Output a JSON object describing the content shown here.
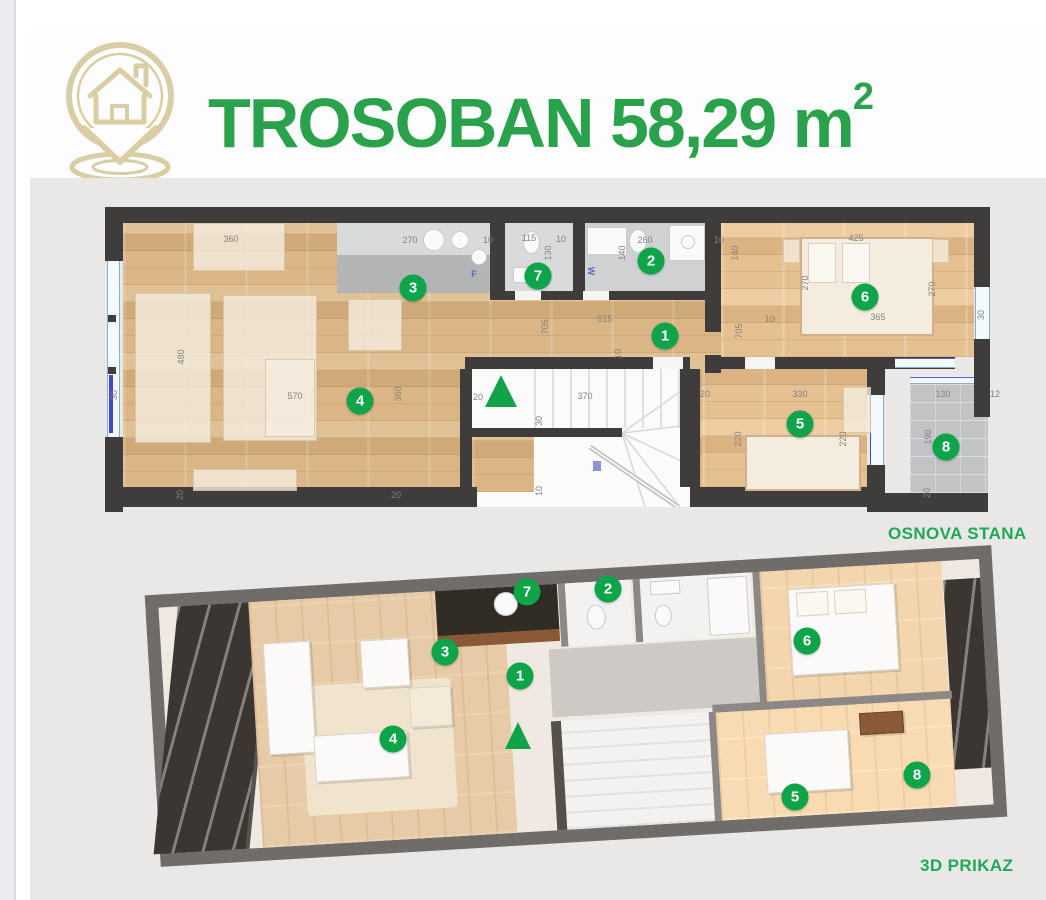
{
  "header": {
    "title": "TROSOBAN 58,29 m",
    "title_sup": "2",
    "logo": "house-location-pin-icon"
  },
  "captions": {
    "plan2d": "OSNOVA STANA",
    "view3d": "3D PRIKAZ"
  },
  "colors": {
    "accent_green": "#2aa24c",
    "badge_green": "#0ea54a",
    "logo_beige": "#d9cda3",
    "wall_dark": "#3e3d3c",
    "wall_3d": "#6f6c6a",
    "wood": "#d8b284",
    "tile_gray": "#cfd1d3",
    "panel_bg": "#eae8e6",
    "window_blue": "#4247c7"
  },
  "plan2d": {
    "circles": [
      {
        "n": "1",
        "x": 560,
        "y": 129
      },
      {
        "n": "2",
        "x": 546,
        "y": 54
      },
      {
        "n": "3",
        "x": 308,
        "y": 81
      },
      {
        "n": "4",
        "x": 255,
        "y": 194
      },
      {
        "n": "5",
        "x": 695,
        "y": 217
      },
      {
        "n": "6",
        "x": 760,
        "y": 90
      },
      {
        "n": "7",
        "x": 433,
        "y": 69
      },
      {
        "n": "8",
        "x": 841,
        "y": 240
      }
    ],
    "dims": [
      {
        "t": "360",
        "x": 126,
        "y": 32
      },
      {
        "t": "270",
        "x": 305,
        "y": 33
      },
      {
        "t": "10",
        "x": 383,
        "y": 33
      },
      {
        "t": "115",
        "x": 424,
        "y": 31
      },
      {
        "t": "130",
        "x": 443,
        "y": 46,
        "v": 1
      },
      {
        "t": "10",
        "x": 456,
        "y": 32
      },
      {
        "t": "140",
        "x": 517,
        "y": 46,
        "v": 1
      },
      {
        "t": "260",
        "x": 540,
        "y": 33
      },
      {
        "t": "10",
        "x": 614,
        "y": 33
      },
      {
        "t": "140",
        "x": 630,
        "y": 46,
        "v": 1
      },
      {
        "t": "425",
        "x": 751,
        "y": 31
      },
      {
        "t": "270",
        "x": 700,
        "y": 76,
        "v": 1
      },
      {
        "t": "270",
        "x": 827,
        "y": 82,
        "v": 1
      },
      {
        "t": "365",
        "x": 773,
        "y": 110
      },
      {
        "t": "30",
        "x": 876,
        "y": 108,
        "v": 1
      },
      {
        "t": "515",
        "x": 500,
        "y": 112
      },
      {
        "t": "705",
        "x": 440,
        "y": 120,
        "v": 1
      },
      {
        "t": "705",
        "x": 634,
        "y": 124,
        "v": 1
      },
      {
        "t": "10",
        "x": 665,
        "y": 112
      },
      {
        "t": "10",
        "x": 513,
        "y": 147,
        "v": 1
      },
      {
        "t": "480",
        "x": 76,
        "y": 150,
        "v": 1
      },
      {
        "t": "30",
        "x": 9,
        "y": 188,
        "v": 1
      },
      {
        "t": "570",
        "x": 190,
        "y": 189
      },
      {
        "t": "360",
        "x": 293,
        "y": 187,
        "v": 1
      },
      {
        "t": "20",
        "x": 373,
        "y": 190
      },
      {
        "t": "370",
        "x": 480,
        "y": 189
      },
      {
        "t": "30",
        "x": 434,
        "y": 214,
        "v": 1
      },
      {
        "t": "10",
        "x": 434,
        "y": 284,
        "v": 1
      },
      {
        "t": "20",
        "x": 75,
        "y": 288,
        "v": 1
      },
      {
        "t": "20",
        "x": 291,
        "y": 288
      },
      {
        "t": "20",
        "x": 600,
        "y": 187
      },
      {
        "t": "330",
        "x": 695,
        "y": 187
      },
      {
        "t": "220",
        "x": 633,
        "y": 232,
        "v": 1
      },
      {
        "t": "220",
        "x": 738,
        "y": 232,
        "v": 1
      },
      {
        "t": "130",
        "x": 838,
        "y": 187
      },
      {
        "t": "12",
        "x": 890,
        "y": 187
      },
      {
        "t": "190",
        "x": 823,
        "y": 230,
        "v": 1
      },
      {
        "t": "20",
        "x": 822,
        "y": 286,
        "v": 1
      }
    ],
    "fixtures": [
      {
        "t": "F",
        "x": 369,
        "y": 67
      },
      {
        "t": "W",
        "x": 486,
        "y": 64,
        "v": 1
      }
    ]
  },
  "view3d": {
    "circles": [
      {
        "n": "1",
        "x": 520,
        "y": 676
      },
      {
        "n": "2",
        "x": 608,
        "y": 589
      },
      {
        "n": "3",
        "x": 445,
        "y": 652
      },
      {
        "n": "4",
        "x": 393,
        "y": 739
      },
      {
        "n": "5",
        "x": 795,
        "y": 797
      },
      {
        "n": "6",
        "x": 807,
        "y": 641
      },
      {
        "n": "7",
        "x": 527,
        "y": 592
      },
      {
        "n": "8",
        "x": 917,
        "y": 775
      }
    ]
  }
}
